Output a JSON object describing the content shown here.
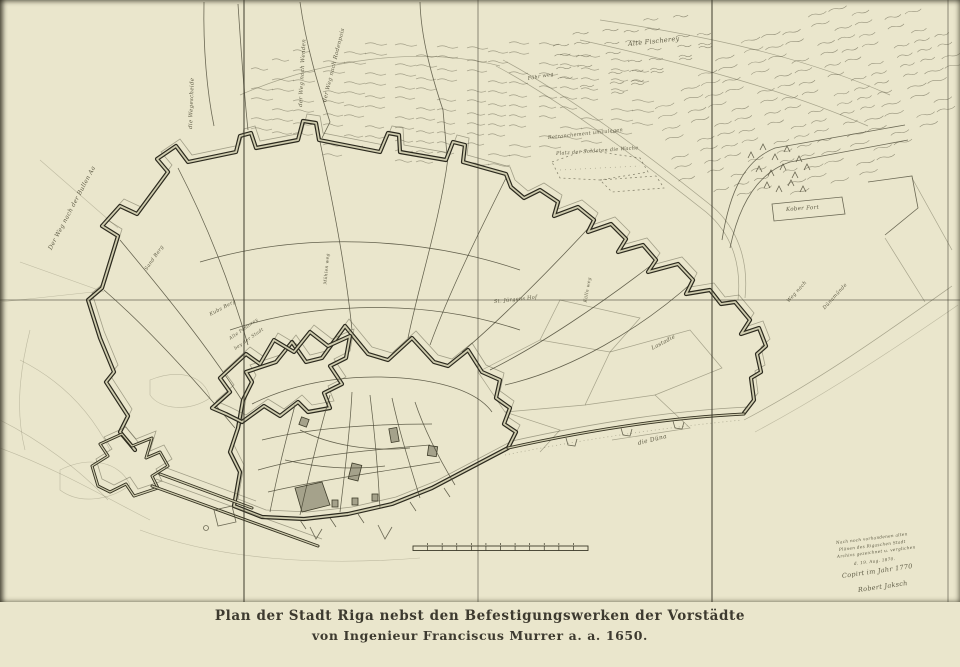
{
  "caption": {
    "line1": "Plan der Stadt Riga nebst den Befestigungswerken der Vorstädte",
    "line2": "von Ingenieur Franciscus Murrer a. a. 1650."
  },
  "colors": {
    "paper": "#ccc9ab",
    "margin": "#eae6cc",
    "ink": "#3f3c2c",
    "rampart_ink": "#2c2a1e"
  },
  "scale_bar": {
    "segments": 12
  },
  "labels": [
    {
      "text": "Der Weg nach der Bullen Aa",
      "x": 50,
      "y": 246,
      "r": -62,
      "s": 6
    },
    {
      "text": "die Wegescheide",
      "x": 191,
      "y": 126,
      "r": -88,
      "s": 5.5
    },
    {
      "text": "der Weg nach Wenden",
      "x": 301,
      "y": 104,
      "r": -87,
      "s": 5.5
    },
    {
      "text": "der Weg nach Rodenpois",
      "x": 325,
      "y": 99,
      "r": -76,
      "s": 5.5
    },
    {
      "text": "Alte Fischerey",
      "x": 628,
      "y": 40,
      "r": -6,
      "s": 6.5
    },
    {
      "text": "Fähr weg",
      "x": 528,
      "y": 76,
      "r": -10,
      "s": 5
    },
    {
      "text": "Retranchement umzulegen",
      "x": 548,
      "y": 135,
      "r": -6,
      "s": 5
    },
    {
      "text": "Platz der Soldaten die Wache",
      "x": 556,
      "y": 151,
      "r": -4,
      "s": 5
    },
    {
      "text": "Kober Fort",
      "x": 786,
      "y": 207,
      "r": -4,
      "s": 5.5
    },
    {
      "text": "Kubs Berg",
      "x": 210,
      "y": 312,
      "r": -28,
      "s": 5
    },
    {
      "text": "Alte Pastorey",
      "x": 230,
      "y": 337,
      "r": -35,
      "s": 4.5
    },
    {
      "text": "bey der Stadt",
      "x": 235,
      "y": 347,
      "r": -35,
      "s": 4.5
    },
    {
      "text": "St. Jürgens Hof",
      "x": 494,
      "y": 299,
      "r": -6,
      "s": 5
    },
    {
      "text": "Lastadie",
      "x": 652,
      "y": 346,
      "r": -28,
      "s": 5.5
    },
    {
      "text": "die Düna",
      "x": 638,
      "y": 440,
      "r": -14,
      "s": 6
    },
    {
      "text": "Weg nach",
      "x": 788,
      "y": 299,
      "r": -48,
      "s": 5
    },
    {
      "text": "Dünamünde",
      "x": 824,
      "y": 306,
      "r": -48,
      "s": 5
    },
    {
      "text": "Sand Berg",
      "x": 146,
      "y": 267,
      "r": -55,
      "s": 5
    },
    {
      "text": "Mühlen weg",
      "x": 326,
      "y": 282,
      "r": -85,
      "s": 4.5
    },
    {
      "text": "Külln weg",
      "x": 586,
      "y": 300,
      "r": -80,
      "s": 4.5
    },
    {
      "text": "Nach noch vorhandenen alten",
      "x": 836,
      "y": 540,
      "r": -7,
      "s": 4.2
    },
    {
      "text": "Plänen des Rigaschen Stadt",
      "x": 839,
      "y": 547,
      "r": -7,
      "s": 4.2
    },
    {
      "text": "Archivs gezeichnet u. verglichen",
      "x": 837,
      "y": 554,
      "r": -7,
      "s": 4.2
    },
    {
      "text": "d. 19. Aug. 1870.",
      "x": 854,
      "y": 561,
      "r": -7,
      "s": 4.2
    },
    {
      "text": "Copirt im Jahr 1770",
      "x": 842,
      "y": 572,
      "r": -8,
      "s": 6.5
    },
    {
      "text": "Robert Jaksch",
      "x": 858,
      "y": 586,
      "r": -8,
      "s": 6.5
    }
  ]
}
